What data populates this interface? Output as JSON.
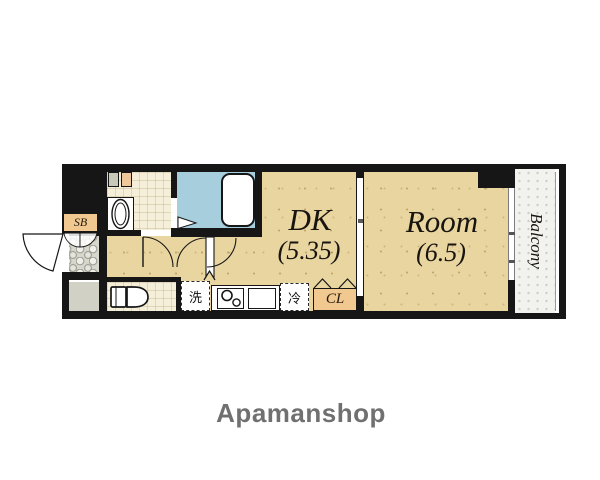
{
  "plan": {
    "dk": {
      "label": "DK",
      "size": "(5.35)"
    },
    "main_room": {
      "label": "Room",
      "size": "(6.5)"
    },
    "balcony": {
      "label": "Balcony"
    },
    "shoe_box": {
      "label": "SB"
    },
    "closet": {
      "label": "CL"
    },
    "washer": {
      "label": "洗"
    },
    "fridge": {
      "label": "冷"
    }
  },
  "footer": {
    "brand": "Apamanshop"
  },
  "colors": {
    "wall": "#161616",
    "floor_tan": "#e9d5a0",
    "bath_blue": "#a7cedd",
    "floor_cream": "#f5eed8",
    "cabinet_orange": "#f1c890",
    "entry_mosaic_gray": "#d8d7ce",
    "porch_gray": "#d2d1c5",
    "balcony_gray": "#f2f2ee",
    "brand_gray": "#707070"
  }
}
